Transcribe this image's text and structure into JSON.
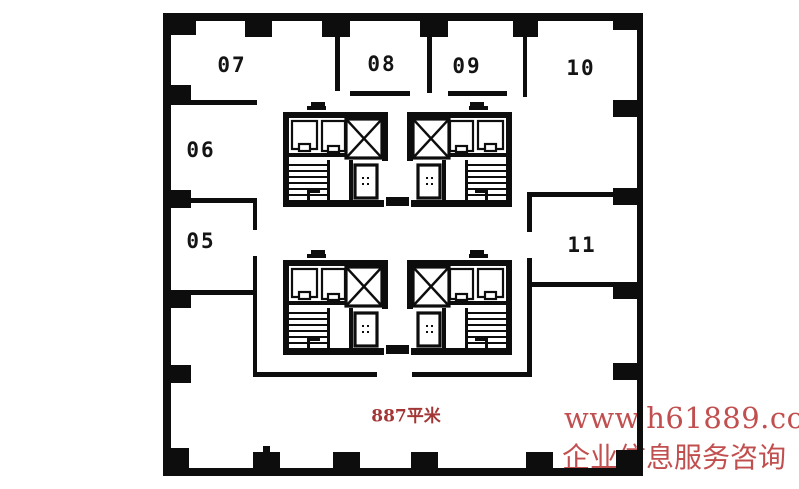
{
  "floor_plan": {
    "units": [
      {
        "id": "07",
        "label": "07"
      },
      {
        "id": "08",
        "label": "08"
      },
      {
        "id": "09",
        "label": "09"
      },
      {
        "id": "10",
        "label": "10"
      },
      {
        "id": "06",
        "label": "06"
      },
      {
        "id": "05",
        "label": "05"
      },
      {
        "id": "11",
        "label": "11"
      }
    ],
    "area_label": "887平米"
  },
  "watermark": {
    "line1": "www.h61889.com",
    "line2": "企业信息服务咨询"
  },
  "colors": {
    "wall": "#0d0d0d",
    "background": "#ffffff",
    "area_text": "#a23535",
    "watermark": "#c24f4f"
  }
}
